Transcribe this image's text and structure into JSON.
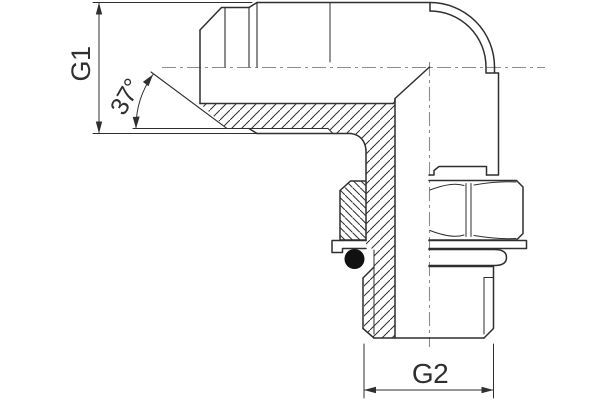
{
  "drawing": {
    "labels": {
      "g1": "G1",
      "g2": "G2",
      "angle": "37°"
    },
    "colors": {
      "line": "#2f2f2f",
      "centerline": "#8c8c8c",
      "background": "#ffffff",
      "o_ring": "#111111"
    }
  }
}
